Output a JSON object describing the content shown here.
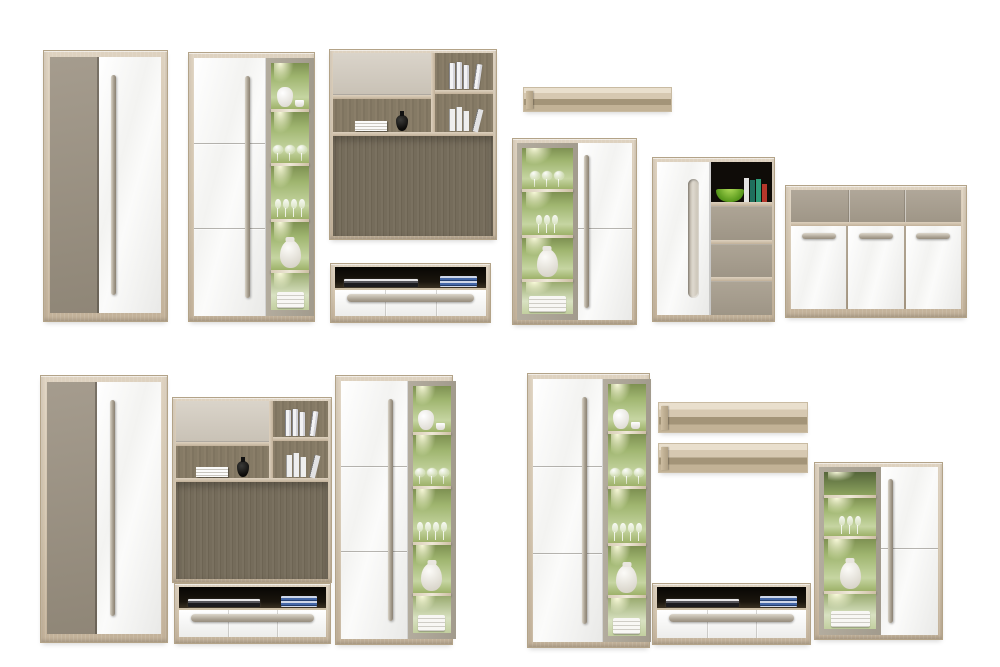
{
  "canvas": {
    "width": 1000,
    "height": 667,
    "background": "#ffffff"
  },
  "palette": {
    "canvas_bg": "#ffffff",
    "wood_mid": "#d2c4ae",
    "taupe_front": "#a59c8e",
    "flap_grey": "#c9c2b6",
    "glass_frame": "#a29b8d",
    "dark_panel": "#756c5b",
    "handle_grey": "#a89f90",
    "drawer_taupe": "#9e9586",
    "niche_dark": "#0f0c08",
    "bowl_green": "#57981b",
    "book_blue": "#4568a8",
    "vase_black": "#0c0b09",
    "led_green_light": "#c6d5a2"
  },
  "items": [
    {
      "id": "wardrobe-top",
      "type": "two-door-wardrobe",
      "x": 43,
      "y": 50,
      "w": 125,
      "h": 272
    },
    {
      "id": "display-cabinet-top",
      "type": "tall-display-cabinet-glass-right",
      "x": 188,
      "y": 52,
      "w": 127,
      "h": 270,
      "contents": [
        "white-jug",
        "wine-glasses",
        "champagne-flutes",
        "white-vase",
        "folded-towels"
      ]
    },
    {
      "id": "wall-panel-top",
      "type": "wall-storage-panel",
      "x": 329,
      "y": 49,
      "w": 168,
      "h": 191,
      "contents": [
        "grey-flap-door",
        "book-stack",
        "black-vase",
        "binders",
        "leaning-books",
        "dark-tv-back-panel"
      ]
    },
    {
      "id": "tv-stand-top",
      "type": "tv-lowboard-three-drawers",
      "x": 330,
      "y": 263,
      "w": 161,
      "h": 60,
      "contents": [
        "dvd-player",
        "blue-books"
      ]
    },
    {
      "id": "wall-shelf-top",
      "type": "floating-wall-shelf",
      "x": 523,
      "y": 87,
      "w": 149,
      "h": 25
    },
    {
      "id": "display-cabinet-small-top",
      "type": "display-cabinet-glass-left",
      "x": 512,
      "y": 138,
      "w": 125,
      "h": 187,
      "contents": [
        "wine-glasses",
        "champagne-flutes",
        "white-vase",
        "folded-towels"
      ]
    },
    {
      "id": "chest",
      "type": "door-and-drawer-chest",
      "x": 652,
      "y": 157,
      "w": 123,
      "h": 165,
      "contents": [
        "green-bowl",
        "books"
      ]
    },
    {
      "id": "sideboard",
      "type": "three-door-sideboard",
      "x": 785,
      "y": 185,
      "w": 182,
      "h": 133
    },
    {
      "id": "wardrobe-bottom",
      "type": "two-door-wardrobe",
      "x": 40,
      "y": 375,
      "w": 128,
      "h": 268
    },
    {
      "id": "wall-panel-bottom",
      "type": "wall-storage-panel",
      "x": 172,
      "y": 397,
      "w": 160,
      "h": 186,
      "contents": [
        "grey-flap-door",
        "book-stack",
        "black-vase",
        "binders",
        "leaning-books",
        "dark-tv-back-panel"
      ]
    },
    {
      "id": "tv-stand-bottom-left",
      "type": "tv-lowboard-three-drawers",
      "x": 174,
      "y": 583,
      "w": 157,
      "h": 61,
      "contents": [
        "dvd-player",
        "blue-books"
      ]
    },
    {
      "id": "display-cabinet-bottom-left",
      "type": "tall-display-cabinet-glass-right",
      "x": 335,
      "y": 375,
      "w": 118,
      "h": 270,
      "contents": [
        "white-jug",
        "wine-glasses",
        "champagne-flutes",
        "white-vase",
        "folded-towels"
      ]
    },
    {
      "id": "display-cabinet-bottom-right",
      "type": "tall-display-cabinet-glass-right",
      "x": 527,
      "y": 373,
      "w": 123,
      "h": 275,
      "contents": [
        "white-jug",
        "wine-glasses",
        "champagne-flutes",
        "white-vase",
        "folded-towels"
      ]
    },
    {
      "id": "wall-shelf-upper",
      "type": "floating-wall-shelf",
      "x": 658,
      "y": 402,
      "w": 150,
      "h": 31
    },
    {
      "id": "wall-shelf-lower",
      "type": "floating-wall-shelf",
      "x": 658,
      "y": 443,
      "w": 150,
      "h": 30
    },
    {
      "id": "tv-stand-bottom-right",
      "type": "tv-lowboard-three-drawers",
      "x": 652,
      "y": 583,
      "w": 159,
      "h": 62,
      "contents": [
        "dvd-player",
        "blue-books"
      ]
    },
    {
      "id": "display-cabinet-small-bottom",
      "type": "display-cabinet-glass-left",
      "x": 814,
      "y": 462,
      "w": 129,
      "h": 178,
      "contents": [
        "champagne-flutes",
        "white-vase",
        "folded-towels"
      ]
    }
  ]
}
